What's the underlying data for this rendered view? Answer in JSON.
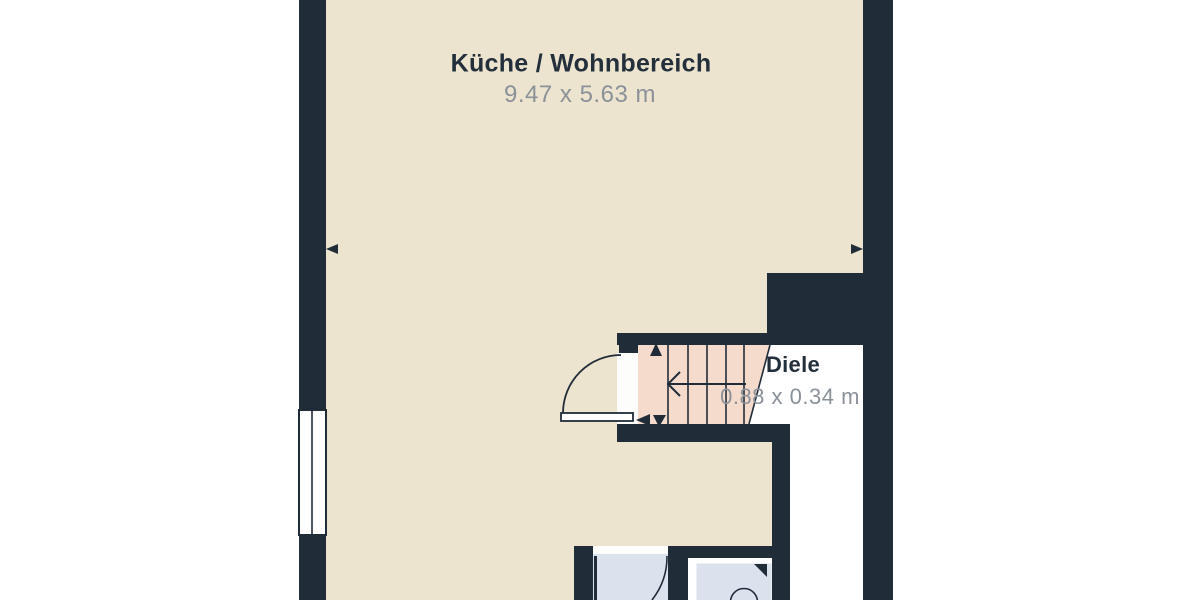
{
  "floorplan": {
    "rooms": [
      {
        "id": "kitchen-living",
        "name": "Küche / Wohnbereich",
        "dimensions": "9.47 x 5.63 m"
      },
      {
        "id": "hallway",
        "name": "Diele",
        "dimensions": "0.88 x 0.34 m"
      }
    ],
    "features": [
      "staircase",
      "entry-door",
      "bathroom-door",
      "shower",
      "window",
      "dimension-arrows"
    ],
    "colors": {
      "wall": "#212c39",
      "floor-main": "#ece4ce",
      "floor-stairs": "#f5dbcc",
      "floor-bath": "#dce1ee",
      "floor-hall": "#ffffff",
      "label": "#242f3c",
      "dimension": "#8b9199",
      "page-bg": "#ffffff"
    }
  }
}
